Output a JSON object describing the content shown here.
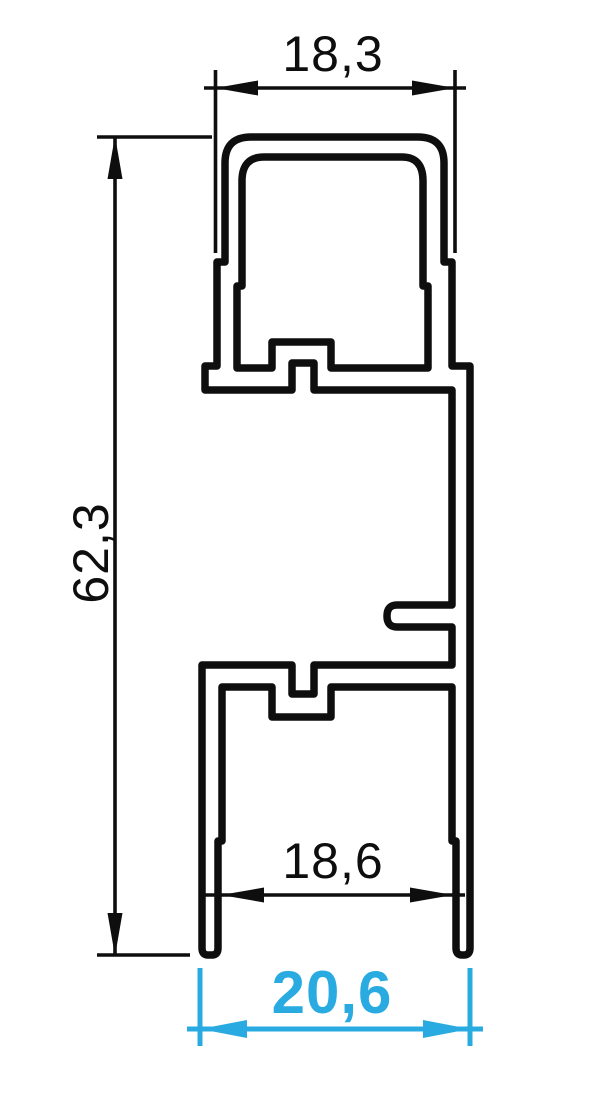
{
  "colors": {
    "background": "#ffffff",
    "profile_line": "#0e0e0e",
    "dimension_line": "#0e0e0e",
    "accent": "#29abe2"
  },
  "dimensions": {
    "top_outer_width": "18,3",
    "overall_height": "62,3",
    "bottom_inner_width": "18,6",
    "bottom_overall_width": "20,6"
  }
}
